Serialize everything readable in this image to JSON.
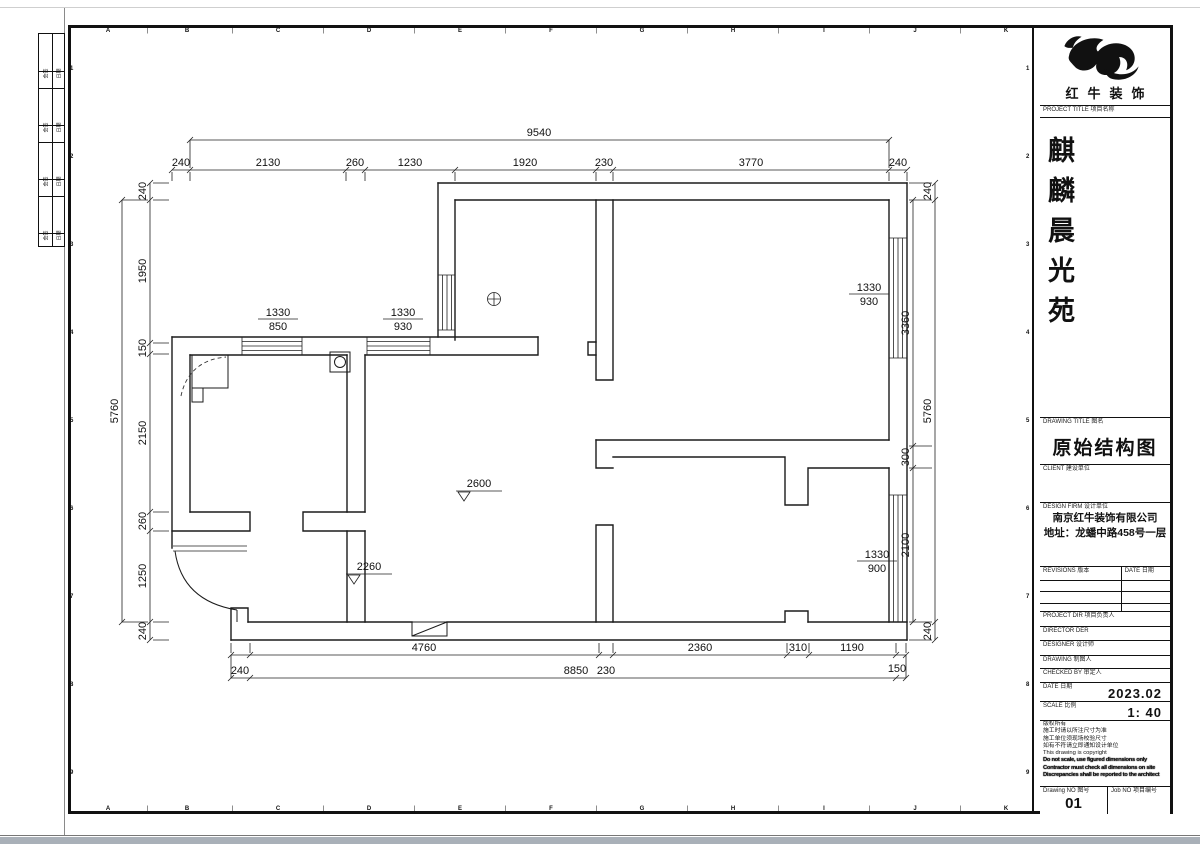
{
  "page": {
    "bottom_bar_color": "#a9b0b8"
  },
  "sheet": {
    "col_letters": [
      "A",
      "B",
      "C",
      "D",
      "E",
      "F",
      "G",
      "H",
      "I",
      "J",
      "K"
    ],
    "row_numbers": [
      "1",
      "2",
      "3",
      "4",
      "5",
      "6",
      "7",
      "8",
      "9"
    ],
    "side_strip_cells": [
      "会签",
      "日期",
      "会签",
      "日期",
      "会签",
      "日期",
      "会签",
      "日期"
    ]
  },
  "plan": {
    "dim_top_total": "9540",
    "dim_top": [
      "240",
      "2130",
      "260",
      "1230",
      "1920",
      "230",
      "3770",
      "240"
    ],
    "dim_left_total": "5760",
    "dim_left": [
      "240",
      "1950",
      "150",
      "2150",
      "260",
      "1250",
      "240"
    ],
    "dim_right": [
      "3360",
      "300",
      "2100"
    ],
    "dim_right_outer": [
      "240",
      "5760",
      "240"
    ],
    "dim_bottom_upper": [
      "4760",
      "230",
      "2360",
      "310",
      "1190"
    ],
    "dim_bottom_lower": [
      "240",
      "8850",
      "150"
    ],
    "window_labels": [
      {
        "w": "1330",
        "s": "850"
      },
      {
        "w": "1330",
        "s": "930"
      },
      {
        "w": "1330",
        "s": "930"
      },
      {
        "w": "1330",
        "s": "900"
      }
    ],
    "ceiling_heights": [
      "2600",
      "2260"
    ]
  },
  "title_block": {
    "brand": "红牛装饰",
    "project_label": "PROJECT TITLE 项目名称",
    "project_name": "麒麟晨光苑",
    "drawing_title_label": "DRAWING TITLE 图名",
    "drawing_title": "原始结构图",
    "client_label": "CLIENT 建设单位",
    "design_firm_label": "DESIGN FIRM 设计单位",
    "design_firm_name": "南京红牛装饰有限公司",
    "design_firm_address": "地址：龙蟠中路458号一层",
    "revisions_label": "REVISIONS 版本",
    "revision_date_label": "DATE 日期",
    "project_dir_label": "PROJECT DIR 项目负责人",
    "director_label": "DIRECTOR DER",
    "designer_label": "DESIGNER 设计师",
    "drawing_by_label": "DRAWING 制图人",
    "checked_by_label": "CHECKED BY 审定人",
    "date_label": "DATE 日期",
    "date_value": "2023.02",
    "scale_label": "SCALE 比例",
    "scale_value": "1: 40",
    "notes": [
      "版权所有",
      "施工时请以所注尺寸为准",
      "施工单位须现场校验尺寸",
      "如有不符请立即通知设计单位",
      "This drawing is copyright",
      "Do not scale, use figured dimensions only",
      "Contractor must check all dimensions on site",
      "Discrepancies shall be reported to the architect"
    ],
    "drawing_no_label": "Drawing NO 图号",
    "drawing_no": "01",
    "job_no_label": "Job NO 项目编号"
  }
}
